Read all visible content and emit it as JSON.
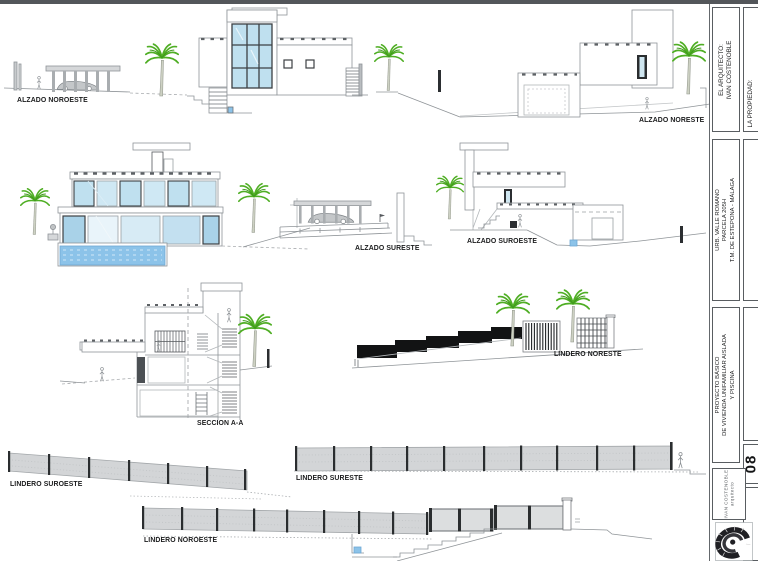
{
  "page": {
    "background": "#ffffff",
    "topbar_color": "#53565a"
  },
  "labels": {
    "alzado_noroeste": "ALZADO NOROESTE",
    "alzado_noreste": "ALZADO NORESTE",
    "alzado_sureste": "ALZADO SURESTE",
    "alzado_suroeste": "ALZADO SUROESTE",
    "seccion_aa": "SECCION A-A",
    "lindero_noreste": "LINDERO NORESTE",
    "lindero_suroeste": "LINDERO SUROESTE",
    "lindero_sureste": "LINDERO SURESTE",
    "lindero_noroeste": "LINDERO NOROESTE"
  },
  "title_block": {
    "architect_label": "EL ARQUITECTO:",
    "architect_name": "IVAN COSTENOBLE",
    "property_label": "LA PROPIEDAD:",
    "location_line1": "URB. VALLE ROMANO",
    "location_line2": "PARCELA 205H",
    "location_line3": "T.M. DE ESTEPONA - MÁLAGA",
    "project_line1": "PROYECTO BÁSICO",
    "project_line2": "DE VIVIENDA UNIFAMILIAR AISLADA",
    "project_line3": "Y PISCINA",
    "firm_name": "IVAN COSTENOBLE",
    "firm_role": "arquitecto",
    "sheet_number": "08"
  },
  "colors": {
    "glass_blue": "#bfe0ef",
    "water_blue": "#8cc3e9",
    "palm_green": "#4fae24",
    "wall_black": "#121314",
    "fence_gray": "#d3d5d7",
    "line_gray": "#8f9498"
  }
}
